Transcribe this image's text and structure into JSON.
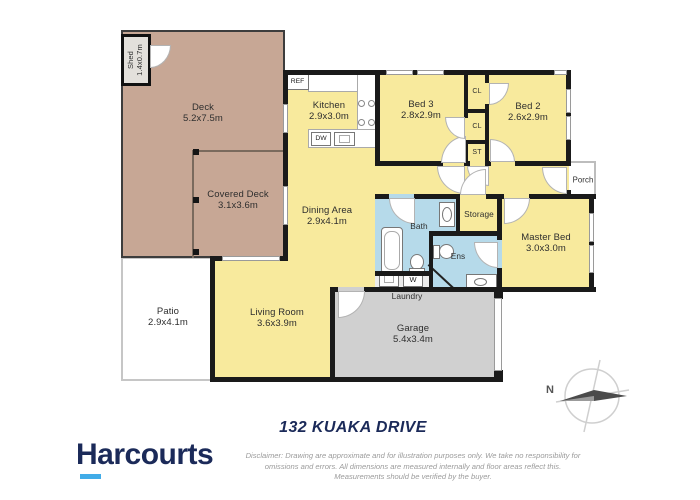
{
  "title": "132 KUAKA DRIVE",
  "branding": {
    "logo_text": "Harcourts"
  },
  "disclaimer": {
    "line1": "Disclaimer: Drawing are approximate and for illustration purposes only. We take no responsibility for",
    "line2": "omissions and errors. All dimensions are measured internally and floor areas reflect this.",
    "line3": "Measurements should be verified by the buyer."
  },
  "compass": {
    "north": "N"
  },
  "rooms": {
    "deck": {
      "name": "Deck",
      "dims": "5.2x7.5m"
    },
    "shed": {
      "name": "Shed",
      "dims": "1.4x0.7m"
    },
    "covered_deck": {
      "name": "Covered Deck",
      "dims": "3.1x3.6m"
    },
    "patio": {
      "name": "Patio",
      "dims": "2.9x4.1m"
    },
    "kitchen": {
      "name": "Kitchen",
      "dims": "2.9x3.0m"
    },
    "dining": {
      "name": "Dining Area",
      "dims": "2.9x4.1m"
    },
    "living": {
      "name": "Living Room",
      "dims": "3.6x3.9m"
    },
    "bed3": {
      "name": "Bed 3",
      "dims": "2.8x2.9m"
    },
    "bed2": {
      "name": "Bed 2",
      "dims": "2.6x2.9m"
    },
    "master": {
      "name": "Master Bed",
      "dims": "3.0x3.0m"
    },
    "garage": {
      "name": "Garage",
      "dims": "5.4x3.4m"
    },
    "bath": {
      "name": "Bath"
    },
    "ens": {
      "name": "Ens"
    },
    "laundry": {
      "name": "Laundry"
    },
    "storage": {
      "name": "Storage"
    },
    "porch": {
      "name": "Porch"
    },
    "closet1": {
      "name": "CL"
    },
    "closet2": {
      "name": "CL"
    },
    "closet3": {
      "name": "ST"
    }
  },
  "appliances": {
    "fridge": "REF",
    "dishwasher": "DW",
    "washer": "W"
  },
  "colors": {
    "room_fill": "#F8EA9D",
    "deck_fill": "#C7A795",
    "wet_area_fill": "#B6DAEA",
    "garage_fill": "#D0D0D0",
    "wall": "#1A1A1A",
    "brand_navy": "#1B2A59",
    "brand_blue": "#41ACE8",
    "disclaimer_text": "#9B9B9B"
  }
}
